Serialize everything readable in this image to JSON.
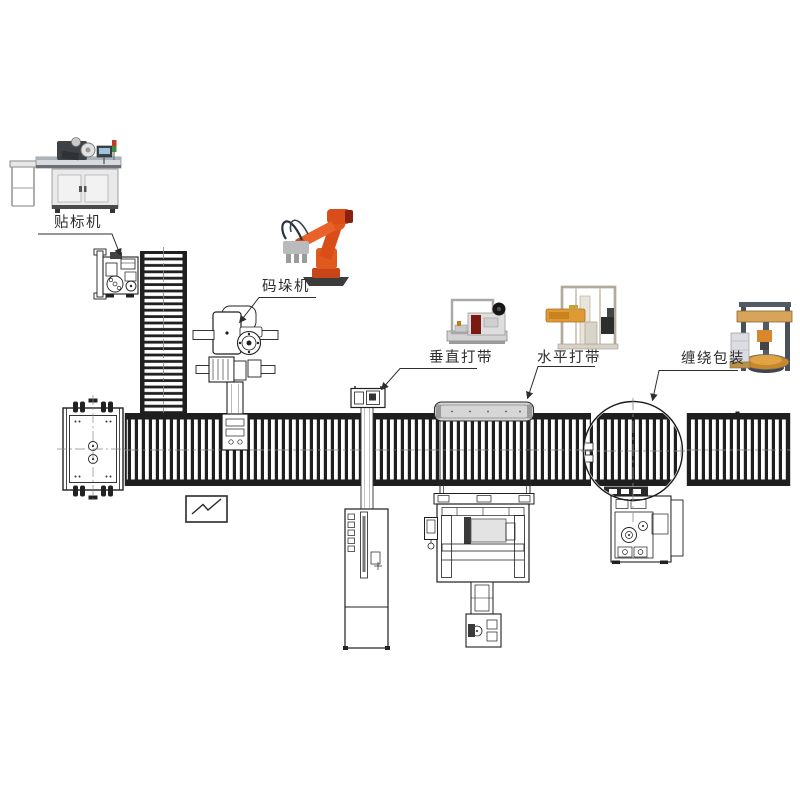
{
  "diagram": {
    "background": "#ffffff",
    "callouts": {
      "labeler": "贴标机",
      "palletizer": "码垛机",
      "vertical_strapper": "垂直打带",
      "horizontal_strapper": "水平打带",
      "wrapper": "缠绕包装"
    },
    "colors": {
      "cad_line": "#1f1f1f",
      "centerline_gray": "#888888",
      "robot_orange": "#d94e18",
      "strapper_arm_orange": "#e09a35",
      "wrapper_beam_tan": "#d8a35a",
      "panel_red": "#7a1a12",
      "machine_gray": "#d6d6d6"
    }
  }
}
